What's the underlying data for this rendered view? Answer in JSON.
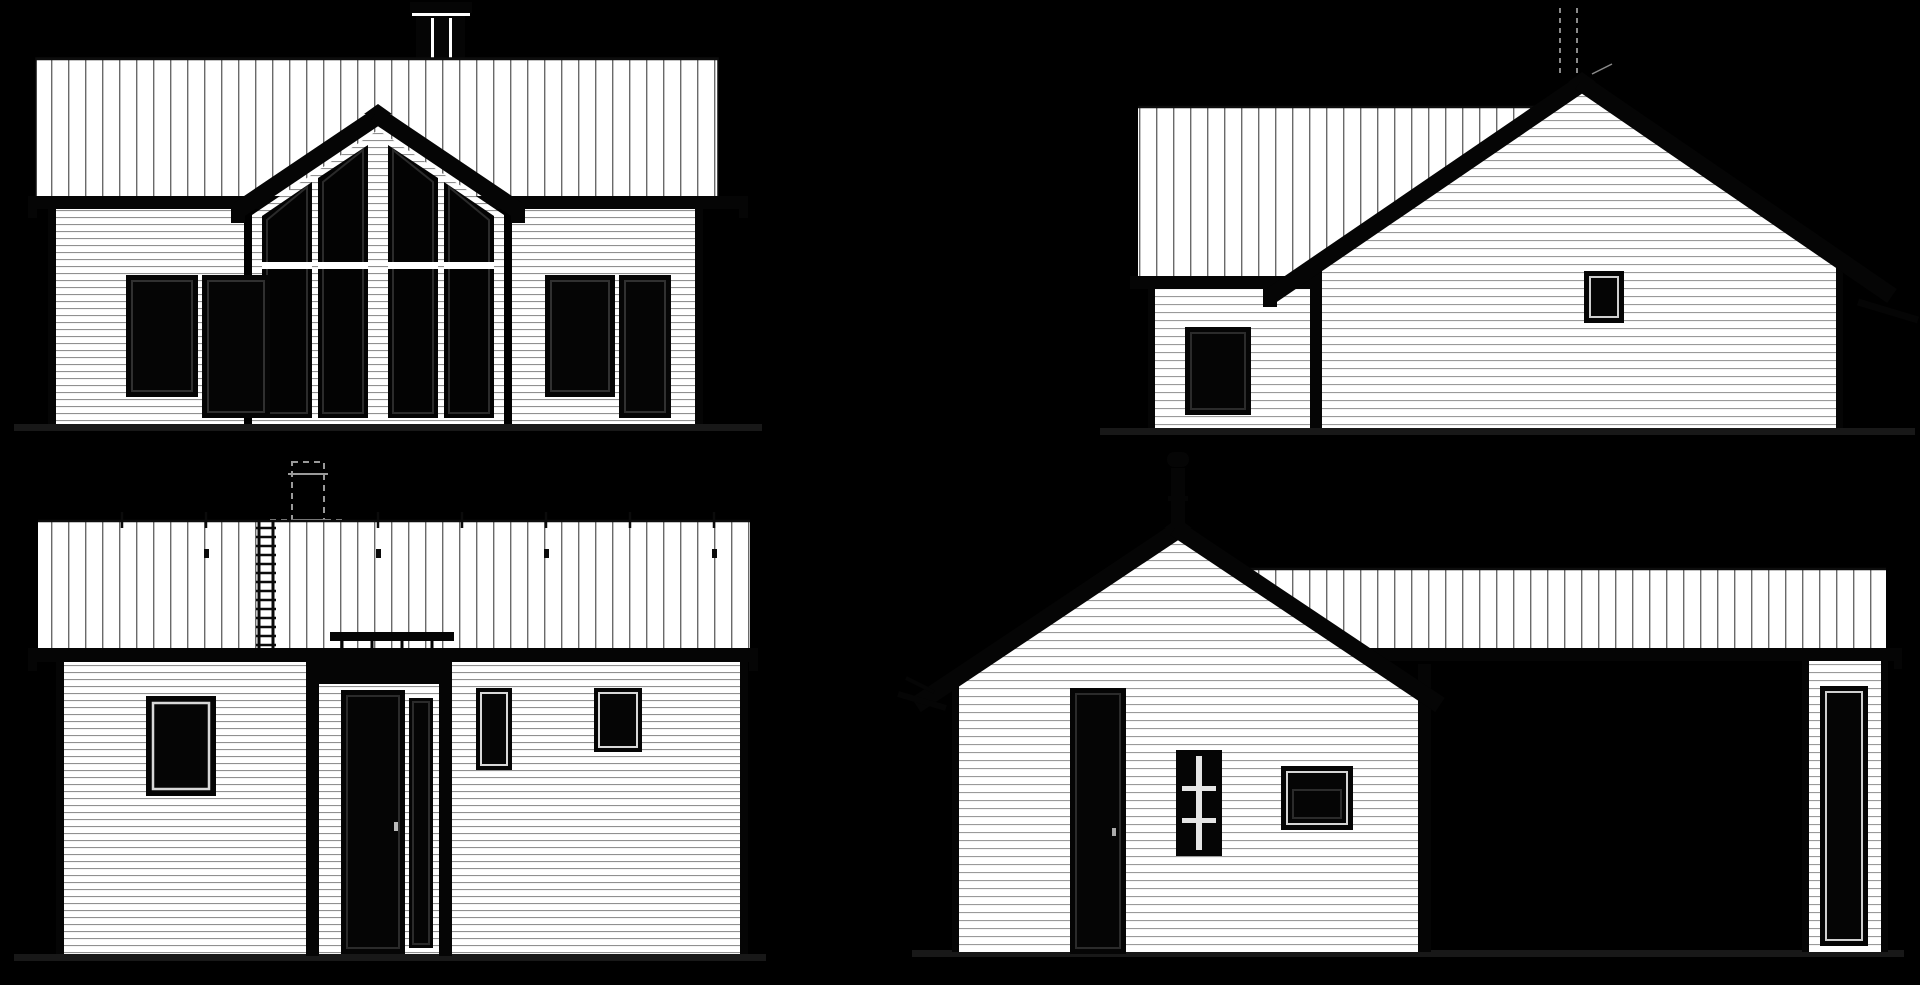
{
  "document": {
    "type": "architectural-elevation-drawing",
    "style": "black-background blueprint presentation, white house elevations",
    "visible_text": ""
  },
  "palette": {
    "background": "#000000",
    "paper": "#ffffff",
    "ink": "#050505",
    "roof_seam_line": "#6a6a6a",
    "siding_line": "#909090",
    "hidden_line_gray": "#9a9a9a",
    "glass": "#030303",
    "ground_line": "#181818",
    "inner_keyline": "#2b2b2b",
    "white_keyline": "#d8d8d8"
  },
  "views": [
    {
      "id": "front-elevation",
      "position": "top-left",
      "features": [
        "chimney-with-cap",
        "standing-seam-roof",
        "eave-fascia-band",
        "center-gable",
        "four-sloped-top-gable-windows",
        "white-mullions",
        "transom-bars",
        "clapboard-siding-walls",
        "left-window-pair",
        "right-window-pair",
        "ground-line"
      ]
    },
    {
      "id": "left-side-elevation",
      "position": "top-right",
      "features": [
        "dashed-flue-above-ridge",
        "wing-roof-standing-seam",
        "wing-eave-band",
        "gable-end-wall",
        "rake-barge-boards",
        "small-square-window",
        "side-door",
        "corner-post",
        "ground-line"
      ]
    },
    {
      "id": "rear-elevation",
      "position": "bottom-left",
      "features": [
        "dashed-hidden-chimney",
        "standing-seam-roof",
        "roof-ladder",
        "snow-guard-ticks",
        "snow-guard-bar-over-entry",
        "entry-bay-with-header",
        "entry-door-with-sidelight",
        "left-window",
        "two-right-windows",
        "ground-line"
      ]
    },
    {
      "id": "right-side-elevation",
      "position": "bottom-right",
      "features": [
        "vent-pipe-with-cap",
        "gable-end-wall",
        "rake-barge-boards",
        "wing-roof-standing-seam",
        "wing-eave-band",
        "side-door",
        "small-grid-window",
        "wide-low-window",
        "far-wall-strip-with-tall-window",
        "ground-line"
      ]
    }
  ]
}
